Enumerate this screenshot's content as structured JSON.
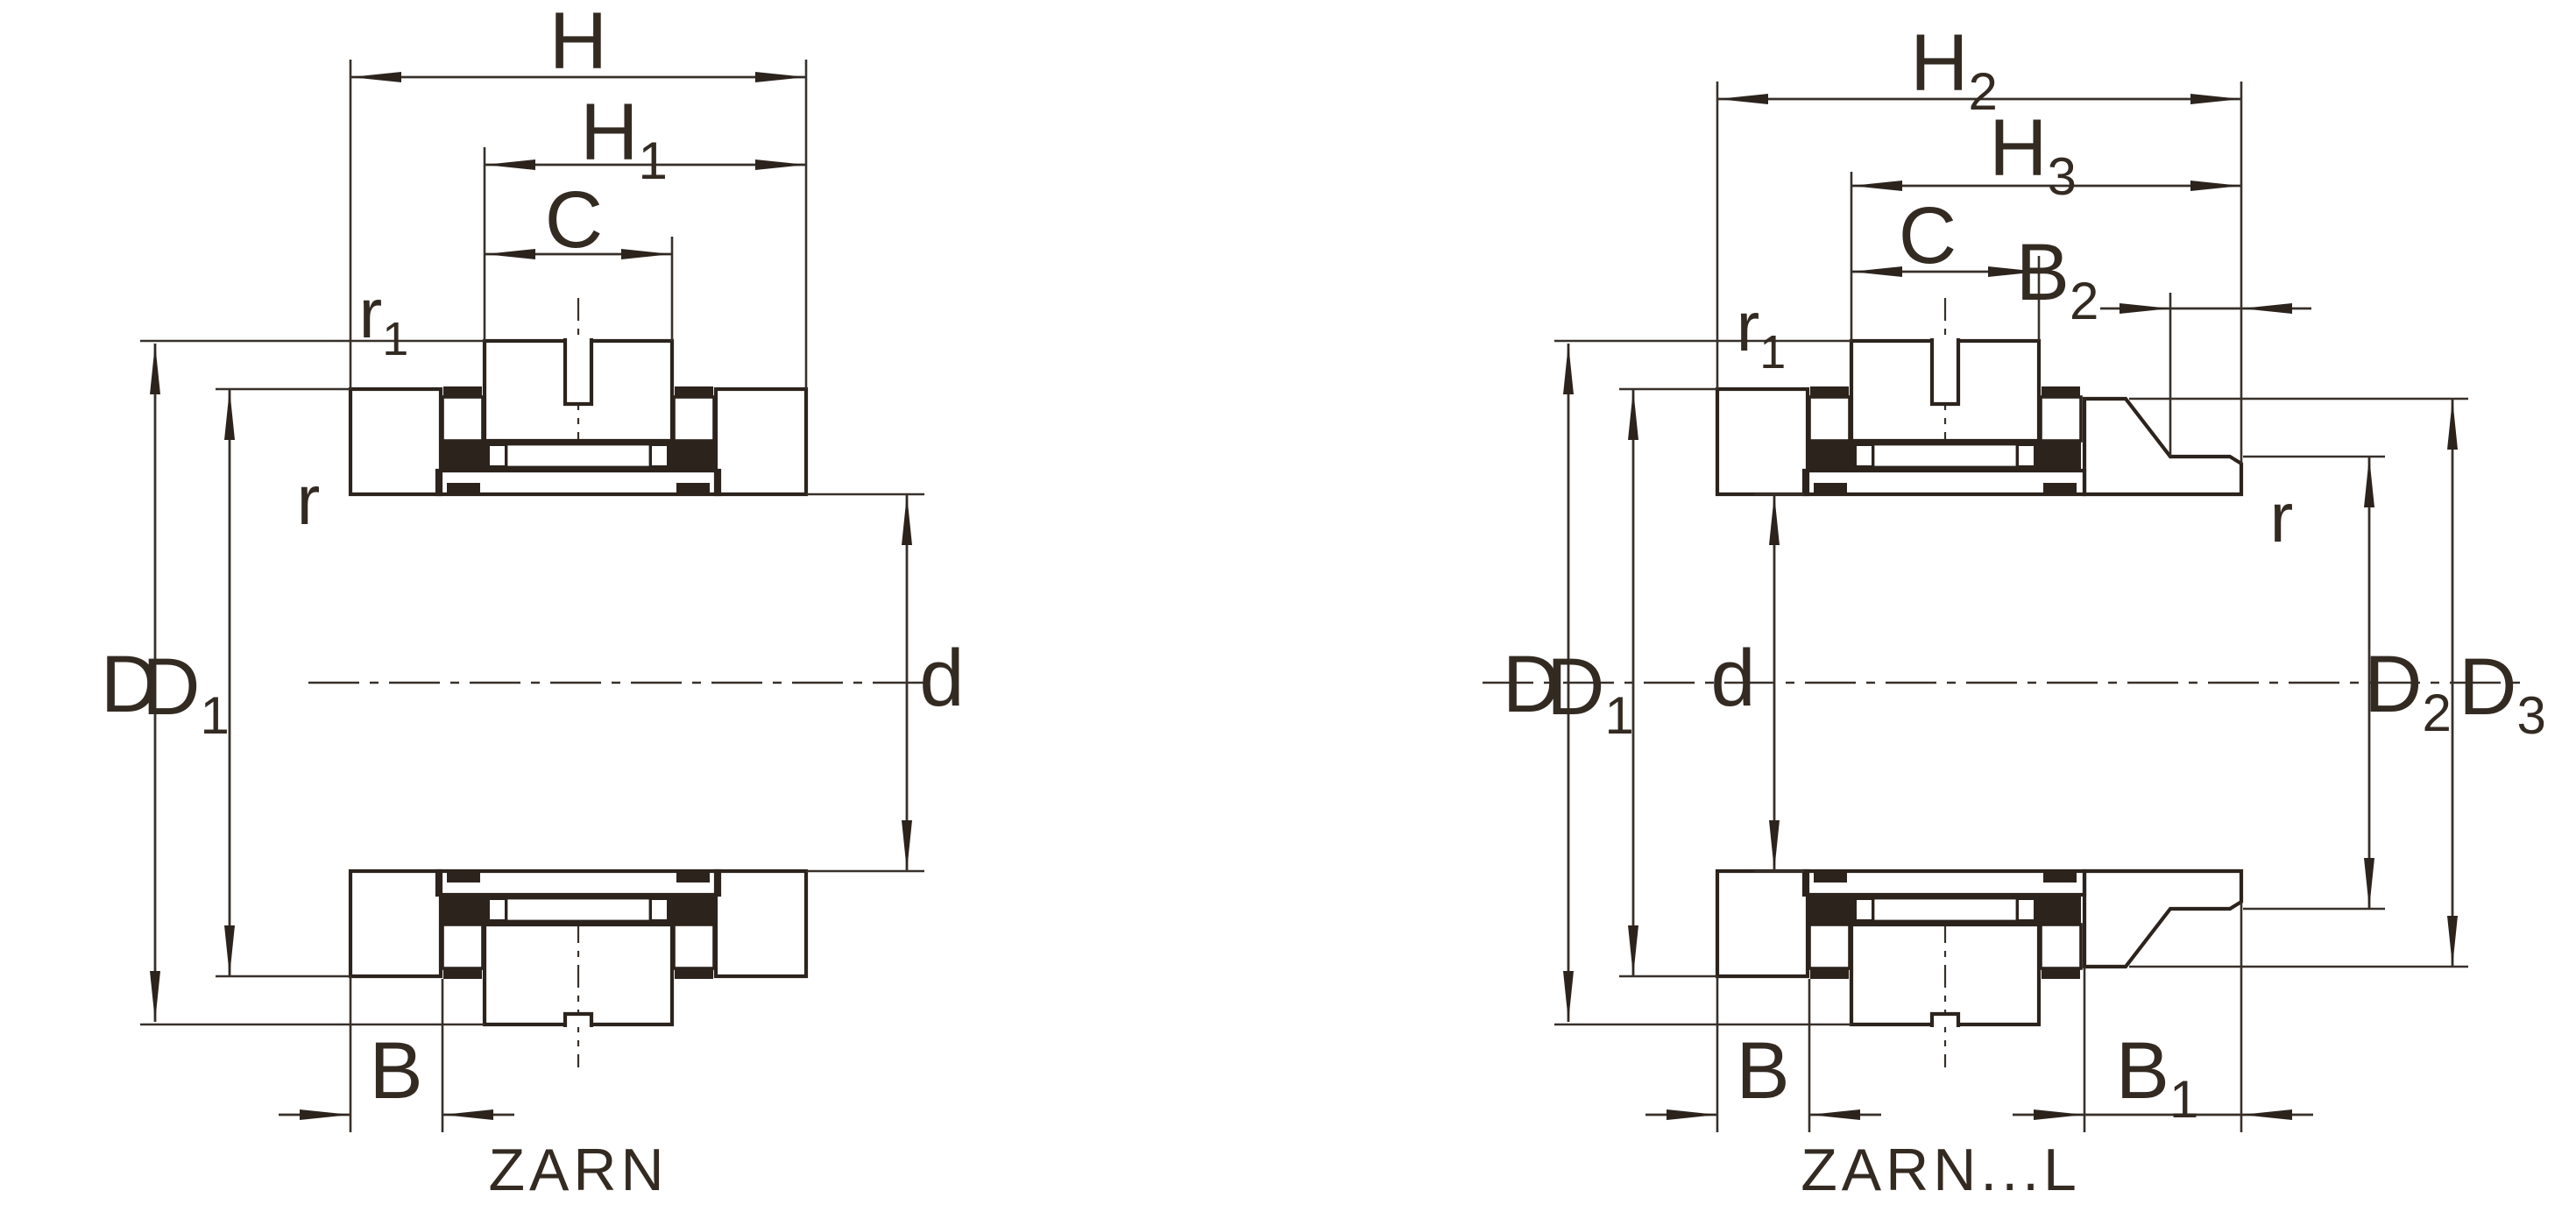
{
  "drawing": {
    "type": "technical-bearing-cross-section",
    "background": "#ffffff",
    "line_color": "#2c231d",
    "figures": [
      {
        "caption": "ZARN",
        "dim_labels": {
          "H": {
            "base": "H",
            "sub": ""
          },
          "H1": {
            "base": "H",
            "sub": "1"
          },
          "C": {
            "base": "C",
            "sub": ""
          },
          "r1": {
            "base": "r",
            "sub": "1"
          },
          "r": {
            "base": "r",
            "sub": ""
          },
          "D": {
            "base": "D",
            "sub": ""
          },
          "D1": {
            "base": "D",
            "sub": "1"
          },
          "d": {
            "base": "d",
            "sub": ""
          },
          "B": {
            "base": "B",
            "sub": ""
          }
        }
      },
      {
        "caption": "ZARN...L",
        "dim_labels": {
          "H2": {
            "base": "H",
            "sub": "2"
          },
          "H3": {
            "base": "H",
            "sub": "3"
          },
          "C": {
            "base": "C",
            "sub": ""
          },
          "B2": {
            "base": "B",
            "sub": "2"
          },
          "r1": {
            "base": "r",
            "sub": "1"
          },
          "r": {
            "base": "r",
            "sub": ""
          },
          "D": {
            "base": "D",
            "sub": ""
          },
          "D1": {
            "base": "D",
            "sub": "1"
          },
          "d": {
            "base": "d",
            "sub": ""
          },
          "D2": {
            "base": "D",
            "sub": "2"
          },
          "D3": {
            "base": "D",
            "sub": "3"
          },
          "B": {
            "base": "B",
            "sub": ""
          },
          "B1": {
            "base": "B",
            "sub": "1"
          }
        }
      }
    ]
  }
}
